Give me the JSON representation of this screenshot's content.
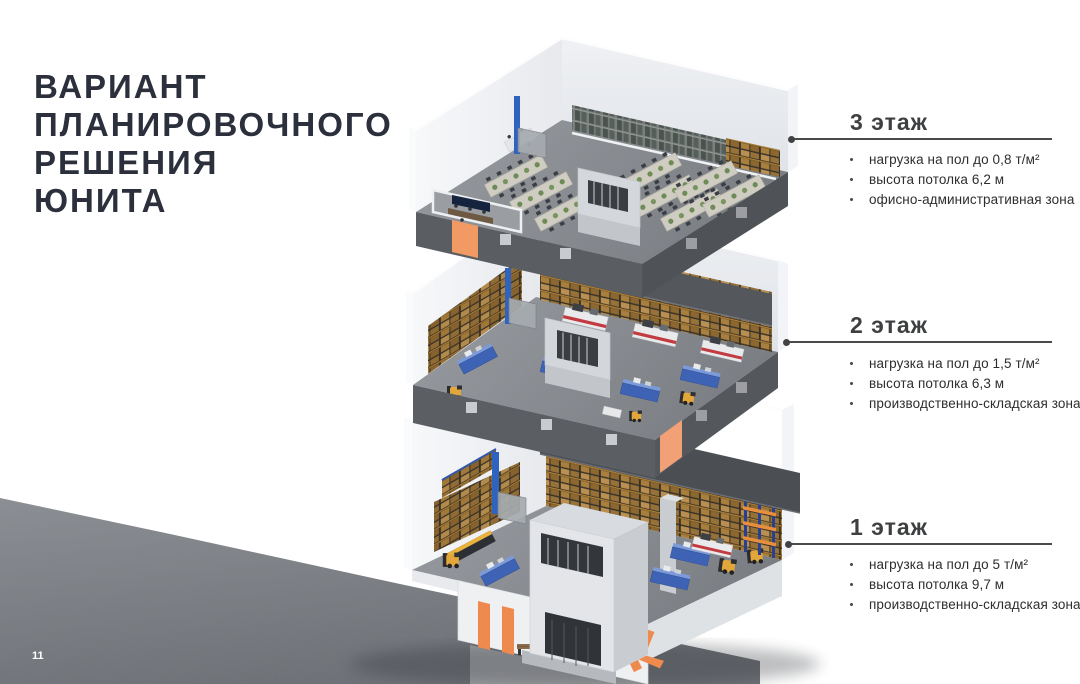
{
  "slide": {
    "title_lines": [
      "ВАРИАНТ",
      "ПЛАНИРОВОЧНОГО",
      "РЕШЕНИЯ",
      "ЮНИТА"
    ],
    "page_number": "11"
  },
  "floors": [
    {
      "id": "floor-3",
      "label": "3 этаж",
      "bullets": [
        "нагрузка на пол до 0,8 т/м²",
        "высота потолка 6,2 м",
        "офисно-административная зона"
      ]
    },
    {
      "id": "floor-2",
      "label": "2 этаж",
      "bullets": [
        "нагрузка на пол до 1,5 т/м²",
        "высота потолка 6,3 м",
        "производственно-складская зона"
      ]
    },
    {
      "id": "floor-1",
      "label": "1 этаж",
      "bullets": [
        "нагрузка на пол до 5 т/м²",
        "высота потолка 9,7 м",
        "производственно-складская зона"
      ]
    }
  ],
  "illustration": {
    "type": "3D exploded cutaway of a three-storey industrial unit",
    "floor3_scene": "office-administrative floor with desk rows, meeting room and server racks",
    "floor2_scene": "production-warehouse floor with pallet racking, machine stations and forklifts",
    "floor1_scene": "tall ground warehouse floor with pallet racking, machines, forklifts and orange entrance graphics"
  },
  "colors": {
    "title_text": "#2c303d",
    "heading_text": "#3e3f41",
    "body_text": "#2e2e2e",
    "leader_line": "#4a4a4a",
    "accent_orange": "#EE8A4D",
    "crate_brown": "#A87F3C",
    "machine_blue": "#3F63B4",
    "forklift_yellow": "#E2A63B",
    "concrete_gray": "#7E8287"
  }
}
